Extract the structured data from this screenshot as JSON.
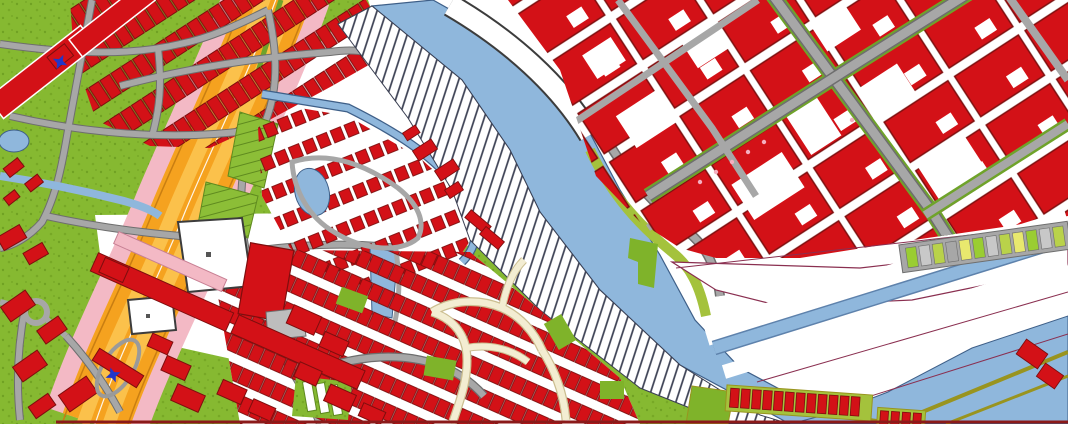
{
  "app": {
    "description": "GIS cadastral base map viewer showing an urban area with a river, canals, highway, dense building blocks and hatched land parcels"
  },
  "map": {
    "colors": {
      "building": "#D31117",
      "building_outline": "#7E0E0E",
      "water": "#8FB7DC",
      "water_edge": "#3E5F88",
      "veg": "#86B931",
      "veg_dark": "#67981C",
      "olive": "#A4C23C",
      "dike": "#99941F",
      "road": "#A7A7A7",
      "road_edge": "#6E6E6E",
      "cream": "#F3EDD2",
      "cream_edge": "#CBBE90",
      "highway": "#F5A21F",
      "highway_lane": "#FBC14B",
      "highway_edge": "#C97E12",
      "shoulder": "#F3B9C5",
      "hatch_line": "#3A3F52",
      "parcel": "#8A2F50",
      "marker": "#2236C8",
      "outline_dark": "#3C3C3C",
      "plaza": "#BDBDBD",
      "garden": "#8CBE37",
      "garden_line": "#5F8A1F",
      "patch_green": "#7FB32A",
      "border": "#8B1A1A",
      "tree_pink": "#F4AFC0",
      "median_green": "#6FA32A"
    },
    "features": [
      {
        "name": "river",
        "kind": "waterway"
      },
      {
        "name": "harbor-basin",
        "kind": "waterway"
      },
      {
        "name": "side-canal",
        "kind": "waterway"
      },
      {
        "name": "neighborhood-pond",
        "kind": "waterway"
      },
      {
        "name": "hatched-parcel-strip",
        "kind": "hatched land parcel along river bank"
      },
      {
        "name": "highway",
        "kind": "orange motorway with pink shoulders"
      },
      {
        "name": "city-block-grid",
        "kind": "dense red building blocks, north-east"
      },
      {
        "name": "row-housing",
        "kind": "red housing rows, north-west"
      },
      {
        "name": "dense-residential",
        "kind": "small red houses, south-centre"
      },
      {
        "name": "pocket-neighborhood",
        "kind": "houses around central pond bounded by canal"
      },
      {
        "name": "quay",
        "kind": "white pier strip on north-east river bank"
      },
      {
        "name": "allotment-gardens",
        "kind": "green plots"
      },
      {
        "name": "greenhouses",
        "kind": "striped glasshouse row"
      },
      {
        "name": "warehouse-row",
        "kind": "red units on dike in harbor"
      },
      {
        "name": "parking-strip",
        "kind": "grey strip with coloured stalls"
      },
      {
        "name": "parcel-boundaries",
        "kind": "thin purple cadastral lines"
      }
    ],
    "markers": [
      {
        "id": "blue-symbol-1",
        "x": 60,
        "y": 62
      },
      {
        "id": "blue-symbol-2",
        "x": 113,
        "y": 375
      }
    ]
  }
}
